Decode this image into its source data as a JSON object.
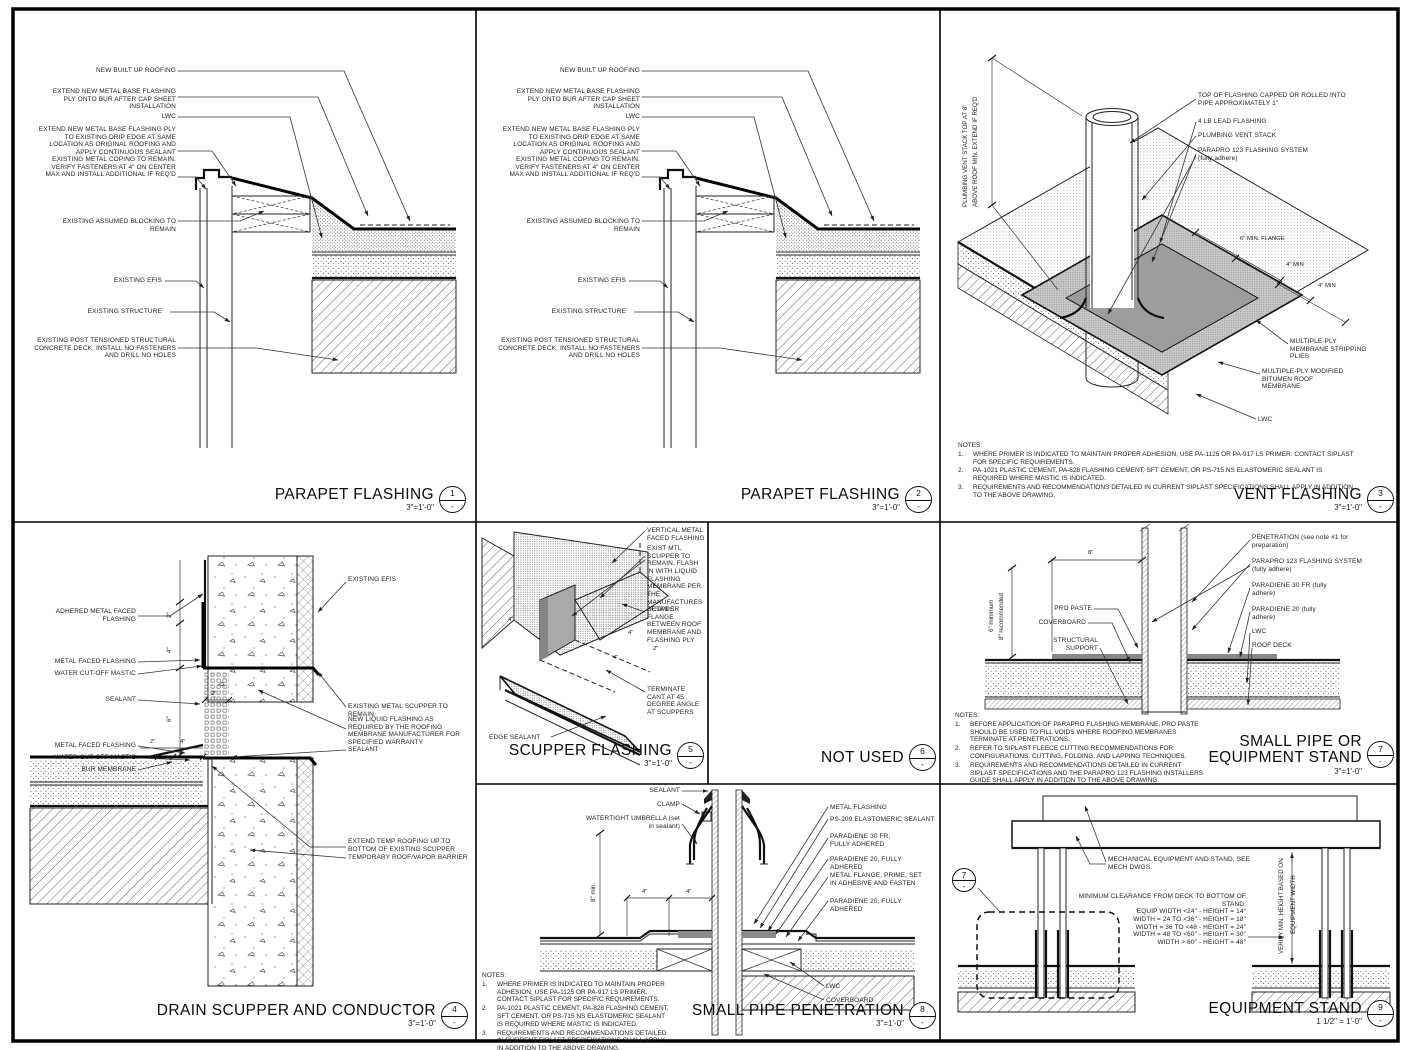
{
  "bubble_ref": "-",
  "notes_label": "NOTES:",
  "parapet_labels": {
    "new_bur": "NEW BUILT UP ROOFING",
    "extend_bur": "EXTEND NEW METAL BASE FLASHING PLY ONTO BUR AFTER CAP SHEET INSTALLATION",
    "lwc": "LWC",
    "extend_drip": "EXTEND NEW METAL BASE FLASHING PLY TO EXISTING DRIP EDGE AT SAME LOCATION AS ORIGINAL ROOFING AND APPLY CONTINUOUS SEALANT",
    "coping": "EXISTING METAL COPING TO REMAIN.  VERIFY FASTENERS AT 4\" ON CENTER MAX AND INSTALL ADDITIONAL IF REQ'D",
    "blocking": "EXISTING ASSUMED BLOCKING TO REMAIN",
    "efis": "EXISTING EFIS",
    "structure": "EXISTING STRUCTURE",
    "deck": "EXISTING POST TENSIONED STRUCTURAL CONCRETE DECK.  INSTALL NO FASTENERS AND DRILL NO HOLES"
  },
  "d1": {
    "num": "1",
    "title": "PARAPET FLASHING",
    "scale": "3\"=1'-0\""
  },
  "d2": {
    "num": "2",
    "title": "PARAPET FLASHING",
    "scale": "3\"=1'-0\""
  },
  "d3": {
    "num": "3",
    "title": "VENT FLASHING",
    "scale": "3\"=1'-0\"",
    "labels": {
      "stack_dim_1": "PLUMBING VENT STACK TOP AT 8\"",
      "stack_dim_2": "ABOVE ROOF MIN.  EXTEND IF REQ'D",
      "top_flashing": "TOP OF FLASHING CAPPED OR ROLLED INTO PIPE APPROXIMATELY 1\"",
      "lead": "4 LB LEAD FLASHING",
      "vent_stack": "PLUMBING VENT STACK",
      "parapro": "PARAPRO 123 FLASHING SYSTEM (fully adhere)",
      "flange_dim": "6\" MIN. FLANGE",
      "min_a": "4\" MIN",
      "min_b": "4\" MIN",
      "stripping": "MULTIPLE-PLY MEMBRANE STRIPPING PLIES",
      "modbit": "MULTIPLE-PLY MODIFIED BITUMEN ROOF MEMBRANE",
      "lwc": "LWC"
    }
  },
  "siplast_notes": [
    {
      "n": "1.",
      "t": "WHERE PRIMER IS INDICATED TO MAINTAIN PROPER ADHESION, USE PA-1125 OR PA-917 LS PRIMER.  CONTACT SIPLAST FOR SPECIFIC REQUIREMENTS."
    },
    {
      "n": "2.",
      "t": "PA-1021 PLASTIC CEMENT, PA-828 FLASHING CEMENT, SFT CEMENT, OR PS-715 NS ELASTOMERIC SEALANT IS REQUIRED WHERE MASTIC IS INDICATED."
    },
    {
      "n": "3.",
      "t": "REQUIREMENTS AND RECOMMENDATIONS DETAILED IN CURRENT SIPLAST SPECIFICATIONS SHALL APPLY IN ADDITION TO THE ABOVE DRAWING."
    }
  ],
  "d4": {
    "num": "4",
    "title": "DRAIN SCUPPER AND CONDUCTOR",
    "scale": "3\"=1'-0\"",
    "labels": {
      "adhered": "ADHERED METAL FACED FLASHING",
      "mff1": "METAL FACED FLASHING",
      "wcm1": "WATER CUT-OFF MASTIC",
      "sealant1": "SEALANT",
      "mff2": "METAL FACED FLASHING",
      "wcm2": "WATER CUT-OFF MASTIC",
      "bur": "BUR MEMBRANE",
      "efis": "EXISTING EFIS",
      "scupper": "EXISTING METAL SCUPPER TO REMAIN",
      "liquid": "NEW LIQUID FLASHING AS REQUIRED BY THE ROOFING MEMBRANE MANUFACTURER FOR SPECIFIED WARRANTY",
      "sealant2": "SEALANT",
      "temp": "EXTEND TEMP ROOFING UP TO BOTTOM OF EXISTING SCUPPER",
      "vapor": "TEMPORARY ROOF/VAPOR BARRIER"
    },
    "dims": {
      "a": "2\"",
      "b": "4\"",
      "c": "2\"",
      "d": "6\"",
      "e": "2\"",
      "f": "4\""
    }
  },
  "d5": {
    "num": "5",
    "title": "SCUPPER FLASHING",
    "scale": "3\"=1'-0\"",
    "labels": {
      "vertical": "VERTICAL METAL FACED FLASHING",
      "exist": "EXIST MTL SCUPPER TO REMAIN, FLASH IN WITH LIQUID FLASHING MEMBRANE PER THE MANUFACTURES DETAILS",
      "flange": "SCUPPER FLANGE BETWEEN ROOF MEMBRANE AND FLASHING PLY",
      "cant": "TERMINATE CANT AT 45 DEGREE ANGLE AT SCUPPERS",
      "edge": "EDGE SEALANT"
    },
    "dims": {
      "a": "4\"",
      "b": "4\"",
      "c": "2\"",
      "d": "4\""
    }
  },
  "d6": {
    "num": "6",
    "title": "NOT USED",
    "scale": ""
  },
  "d7": {
    "num": "7",
    "t1": "SMALL PIPE OR",
    "t2": "EQUIPMENT STAND",
    "scale": "3\"=1'-0\"",
    "labels": {
      "penetration": "PENETRATION (see note #1 for preparation)",
      "parapro": "PARAPRO 123 FLASHING SYSTEM (fully adhere)",
      "par30": "PARADIENE 30 FR (fully adhere)",
      "par20": "PARADIENE 20 (fully adhere)",
      "lwc": "LWC",
      "roof_deck": "ROOF DECK",
      "pro_paste": "PRO PASTE",
      "coverboard": "COVERBOARD",
      "support": "STRUCTURAL SUPPORT",
      "dim8": "8\"",
      "vdim1": "6\" minimum",
      "vdim2": "8\" recommended"
    },
    "notes": [
      {
        "n": "1.",
        "t": "BEFORE APPLICATION OF PARAPRO FLASHING MEMBRANE, PRO PASTE SHOULD BE USED TO FILL VOIDS WHERE ROOFING MEMBRANES TERMINATE AT PENETRATIONS."
      },
      {
        "n": "2.",
        "t": "REFER TO SIPLAST FLEECE CUTTING RECOMMENDATIONS FOR CONFIGURATIONS, CUTTING, FOLDING, AND LAPPING TECHNIQUES."
      },
      {
        "n": "3.",
        "t": "REQUIREMENTS AND RECOMMENDATIONS DETAILED IN CURRENT SIPLAST SPECIFICATIONS AND THE PARAPRO 123 FLASHING INSTALLERS GUIDE SHALL APPLY IN ADDITION TO THE ABOVE DRAWING."
      }
    ]
  },
  "d8": {
    "num": "8",
    "title": "SMALL PIPE PENETRATION",
    "scale": "3\"=1'-0\"",
    "labels": {
      "sealant": "SEALANT",
      "clamp": "CLAMP",
      "umbrella": "WATERTIGHT UMBRELLA (set in sealant)",
      "metal_flashing": "METAL FLASHING",
      "ps209": "PS-209 ELASTOMERIC SEALANT",
      "par30": "PARADIENE 30 FR, FULLY ADHERED",
      "par20a": "PARADIENE 20, FULLY ADHERED",
      "flange": "METAL FLANGE, PRIME, SET IN ADHESIVE AND FASTEN",
      "par20b": "PARADIENE 20, FULLY ADHERED",
      "lwc": "LWC",
      "coverboard": "COVERBOARD",
      "vdim": "8\" min.",
      "dima": "4\"",
      "dimb": "4\""
    }
  },
  "d9": {
    "num": "9",
    "title": "EQUIPMENT STAND",
    "scale": "1 1/2\" = 1'-0\"",
    "labels": {
      "mech": "MECHANICAL EQUIPMENT AND STAND, SEE MECH DWGS.",
      "vdim1": "VERIFY MIN. HEIGHT BASED ON",
      "vdim2": "EQUIPMENT WIDTH",
      "ref": "7"
    },
    "clearance": {
      "title": "MINIMUM CLEARANCE FROM DECK TO BOTTOM OF STAND:",
      "rows": [
        "EQUIP WIDTH <24\" - HEIGHT = 14\"",
        "WIDTH = 24 TO <36\" - HEIGHT = 18\"",
        "WIDTH = 36 TO <48 - HEIGHT = 24\"",
        "WIDTH = 48 TO <60\" - HEIGHT = 30\"",
        "WIDTH > 60\" - HEIGHT = 48\""
      ]
    }
  }
}
